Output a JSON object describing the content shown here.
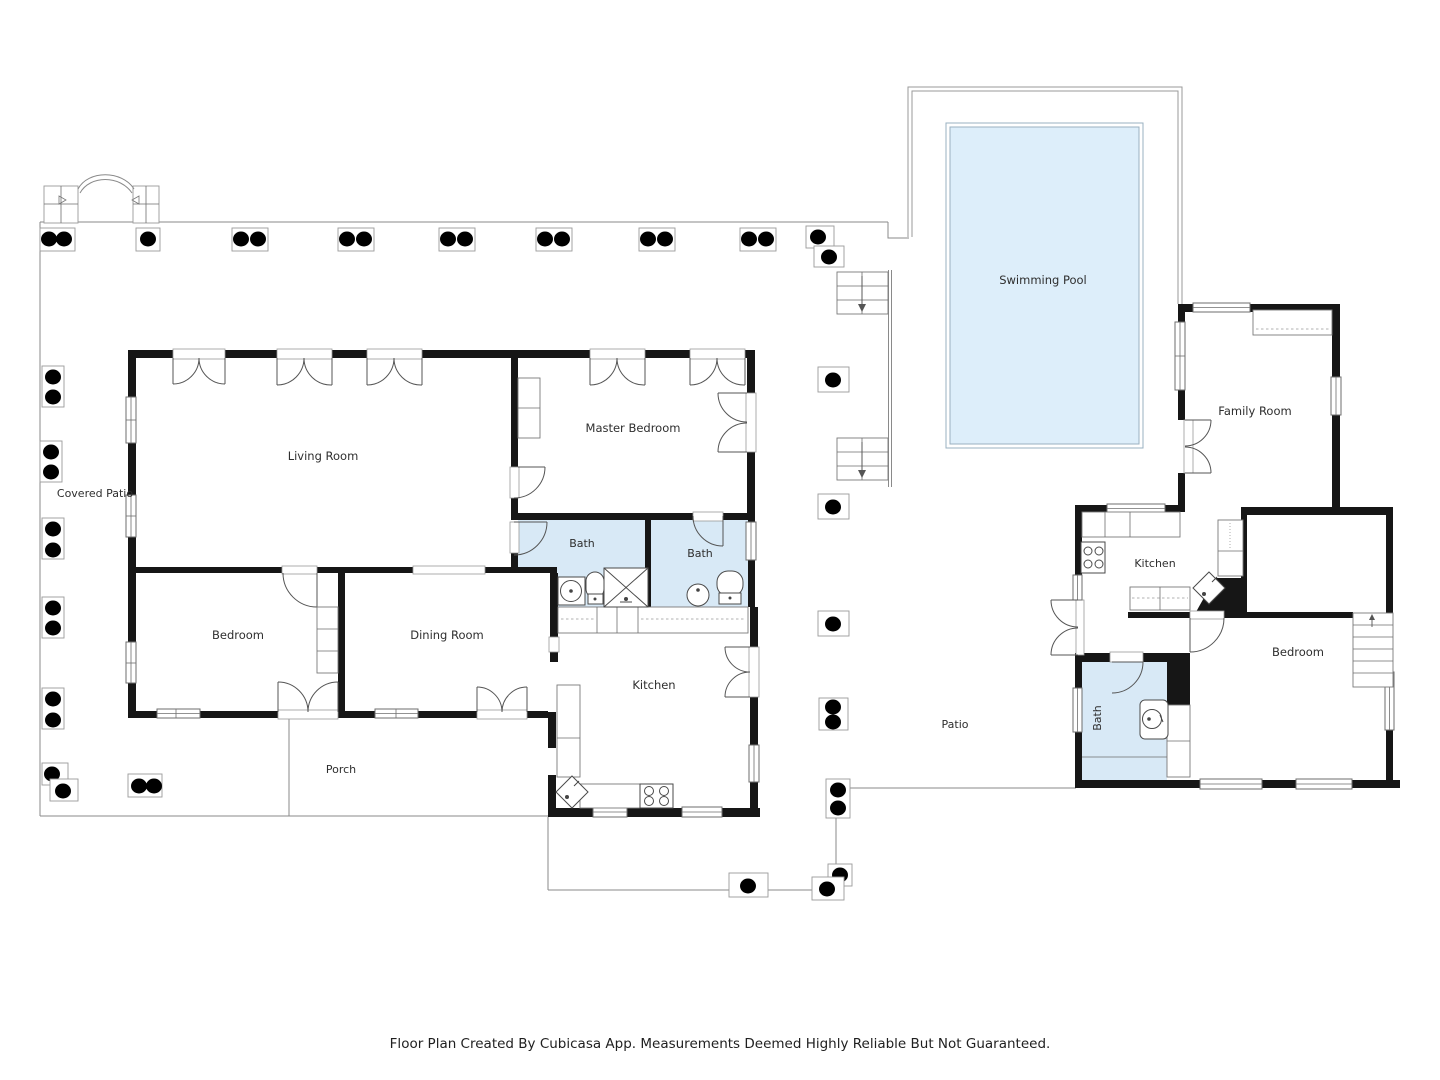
{
  "rooms": {
    "covered_patio": "Covered Patio",
    "living_room": "Living Room",
    "master_bedroom": "Master Bedroom",
    "bedroom": "Bedroom",
    "dining_room": "Dining Room",
    "bath_1": "Bath",
    "bath_2": "Bath",
    "kitchen": "Kitchen",
    "porch": "Porch",
    "swimming_pool": "Swimming Pool",
    "patio": "Patio",
    "family_room": "Family Room",
    "guest_kitchen": "Kitchen",
    "guest_bedroom": "Bedroom",
    "guest_bath": "Bath"
  },
  "footer": {
    "text": "Floor Plan Created By Cubicasa App. Measurements Deemed Highly Reliable But Not Guaranteed."
  },
  "colors": {
    "bath_fill": "#d8e9f6",
    "pool_fill": "#ddeefa",
    "wall": "#161616",
    "outline": "#8a8a8a",
    "text": "#2e2e2e"
  }
}
